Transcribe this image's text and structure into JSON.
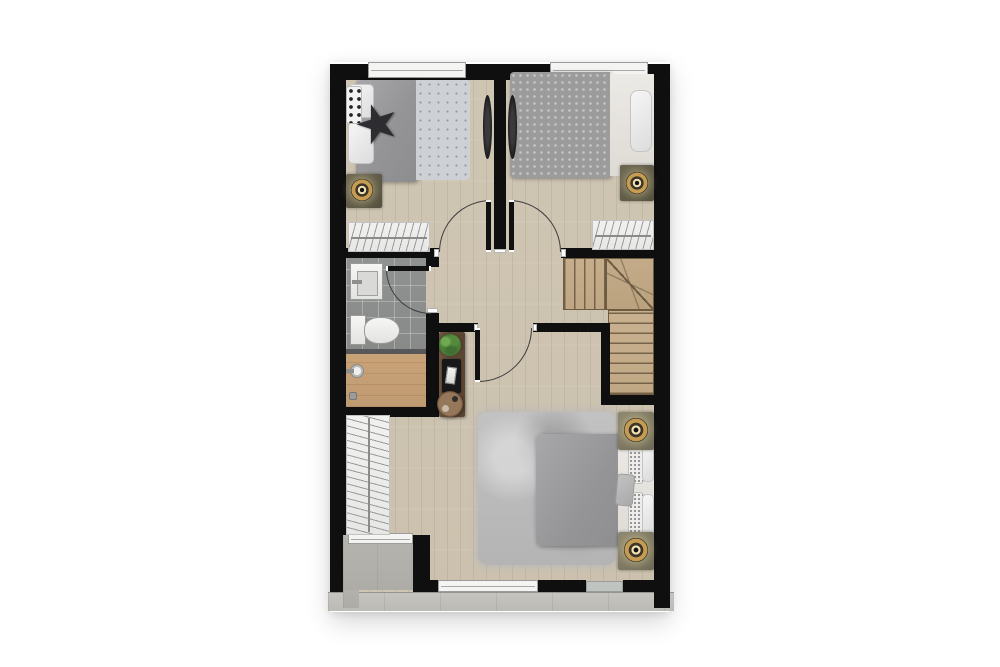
{
  "document": {
    "kind": "architectural floor plan rendering",
    "storey": "upper floor",
    "visible_text": "none",
    "background_color": "#ffffff"
  },
  "palette": {
    "wall": "#0f0f10",
    "wood_floor": "#cfc5b3",
    "bathroom_tile": "#8f9290",
    "shower_wood": "#c9a277",
    "stair_wood": "#c6ae8c",
    "balcony_concrete": "#b6b4af",
    "ledge_concrete": "#c6c4bf",
    "rug": "#bcbcbc",
    "duvet_gray": "#9b9b9b",
    "lamp_gold": "#c69c52",
    "console_wood": "#6e5741",
    "plant_green": "#4c8038"
  },
  "rooms": [
    {
      "id": "bedroom-left",
      "contents": [
        "double-bed",
        "white-pillows",
        "polka-dot-pillow",
        "black-star-pillow",
        "nightstand",
        "table-lamp",
        "wardrobe-with-hangers",
        "wall-tv",
        "window",
        "swing-door"
      ]
    },
    {
      "id": "bedroom-right",
      "contents": [
        "double-bed-patterned-duvet",
        "headboard-cushion",
        "nightstand",
        "table-lamp",
        "wardrobe-with-hangers",
        "wall-tv",
        "window",
        "swing-door"
      ]
    },
    {
      "id": "bathroom",
      "contents": [
        "washbasin",
        "toilet",
        "gray-tile-floor",
        "swing-door",
        "shower-area-wood-deck",
        "shower-head",
        "floor-drain"
      ]
    },
    {
      "id": "hallway",
      "contents": [
        "console-table",
        "potted-plant",
        "decor-tray-with-magazine",
        "round-side-table"
      ]
    },
    {
      "id": "staircase",
      "contents": [
        "upper-flight",
        "winder-turn",
        "lower-flight"
      ]
    },
    {
      "id": "master-bedroom",
      "contents": [
        "double-bed",
        "speckled-pillows",
        "gray-accent-pillow",
        "shaggy-area-rug",
        "nightstand-upper",
        "nightstand-lower",
        "two-table-lamps",
        "tall-wardrobe-with-hangers",
        "swing-door",
        "windows"
      ]
    },
    {
      "id": "balcony",
      "contents": [
        "concrete-deck",
        "sliding-window",
        "perimeter-ledge"
      ]
    }
  ],
  "doors": [
    {
      "id": "door-bedroom-left",
      "type": "swing",
      "state": "open"
    },
    {
      "id": "door-bedroom-right",
      "type": "swing",
      "state": "open"
    },
    {
      "id": "door-bathroom",
      "type": "swing",
      "state": "open"
    },
    {
      "id": "door-master",
      "type": "swing",
      "state": "open"
    }
  ],
  "windows": [
    {
      "id": "window-bedroom-left-top"
    },
    {
      "id": "window-bedroom-right-top"
    },
    {
      "id": "window-master-bottom"
    },
    {
      "id": "window-master-bottom-small"
    },
    {
      "id": "window-balcony-slider"
    }
  ]
}
